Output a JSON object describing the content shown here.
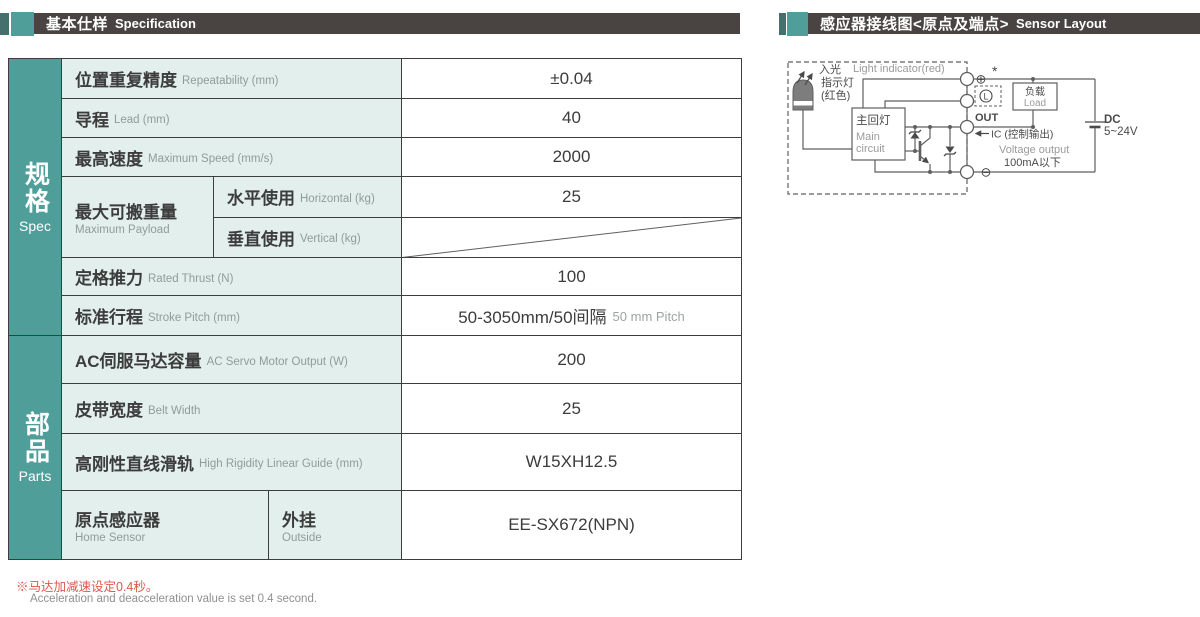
{
  "colors": {
    "teal": "#4f9e99",
    "teal_dark": "#456f6c",
    "header_bar": "#494441",
    "cell_mint": "#e2efec",
    "note_red": "#e0564e",
    "line_gray": "#5f5f5f"
  },
  "header_left": {
    "zh": "基本仕样",
    "en": "Specification"
  },
  "header_right": {
    "zh": "感应器接线图<原点及端点>",
    "en": "Sensor Layout"
  },
  "table": {
    "sections": {
      "spec": {
        "zh": "规格",
        "en": "Spec"
      },
      "parts": {
        "zh": "部品",
        "en": "Parts"
      }
    },
    "rows": {
      "repeatability": {
        "zh": "位置重复精度",
        "en": "Repeatability (mm)",
        "value": "±0.04"
      },
      "lead": {
        "zh": "导程",
        "en": "Lead (mm)",
        "value": "40"
      },
      "max_speed": {
        "zh": "最高速度",
        "en": "Maximum Speed (mm/s)",
        "value": "2000"
      },
      "payload": {
        "zh": "最大可搬重量",
        "en": "Maximum Payload",
        "horizontal": {
          "zh": "水平使用",
          "en": "Horizontal (kg)",
          "value": "25"
        },
        "vertical": {
          "zh": "垂直使用",
          "en": "Vertical (kg)",
          "value": ""
        }
      },
      "rated_thrust": {
        "zh": "定格推力",
        "en": "Rated Thrust (N)",
        "value": "100"
      },
      "stroke_pitch": {
        "zh": "标准行程",
        "en": "Stroke Pitch (mm)",
        "value": "50-3050mm/50间隔",
        "value_en": "50 mm Pitch"
      },
      "servo_output": {
        "zh": "AC伺服马达容量",
        "en": "AC Servo Motor Output (W)",
        "value": "200"
      },
      "belt_width": {
        "zh": "皮带宽度",
        "en": "Belt Width",
        "value": "25"
      },
      "linear_guide": {
        "zh": "高刚性直线滑轨",
        "en": "High Rigidity Linear Guide (mm)",
        "value": "W15XH12.5"
      },
      "home_sensor": {
        "zh": "原点感应器",
        "en": "Home Sensor",
        "sub": {
          "zh": "外挂",
          "en": "Outside"
        },
        "value": "EE-SX672(NPN)"
      }
    }
  },
  "footnote": {
    "zh": "※马达加减速设定0.4秒。",
    "en": "Acceleration and deacceleration value is set 0.4 second."
  },
  "diagram": {
    "light_indicator_en": "Light indicator(red)",
    "light_in_zh": "入光",
    "indicator_zh": "指示灯",
    "red_zh": "(红色)",
    "main_circuit_zh": "主回灯",
    "main_circuit_en_1": "Main",
    "main_circuit_en_2": "circuit",
    "terminal_plus": "⊕",
    "asterisk": "*",
    "lamp_letter": "L",
    "out_label": "OUT",
    "terminal_minus": "⊖",
    "load_zh": "负载",
    "load_en": "Load",
    "ic_label": "IC (控制输出)",
    "voltage_output_en": "Voltage output",
    "current_limit": "100mA以下",
    "dc_label": "DC",
    "dc_range": "5~24V"
  }
}
